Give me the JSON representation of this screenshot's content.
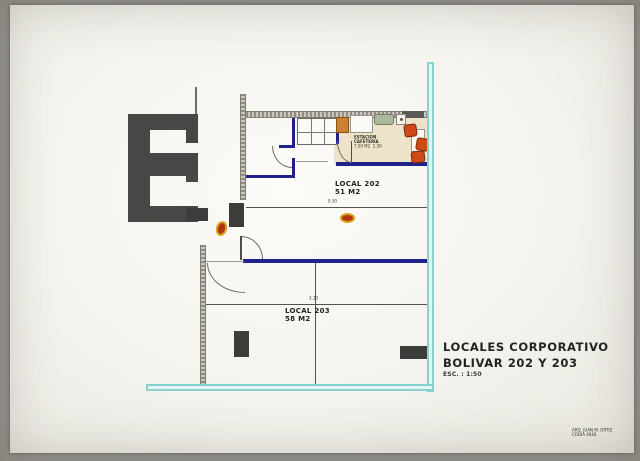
{
  "titleblock": {
    "line1": "LOCALES CORPORATIVO",
    "line2": "BOLIVAR 202 Y 203",
    "scale": "ESC. : 1:50"
  },
  "signature": {
    "line1": "ARQ. JUAN M. ORTIZ",
    "line2": "CODIA 4646"
  },
  "rooms": {
    "local202": {
      "name": "LOCAL 202",
      "area": "51 M2"
    },
    "local203": {
      "name": "LOCAL 203",
      "area": "58 M2"
    },
    "cafeteria": {
      "name_line1": "ESTACION",
      "name_line2": "CAFETERIA",
      "area": "7.50 M2",
      "dim": "1.30"
    }
  },
  "dimensions": {
    "d1": "0.30",
    "d2": "3.10"
  },
  "colors": {
    "wall_blue": "#20218a",
    "glass_cyan": "#86d2cf",
    "furniture_orange": "#cf4a18",
    "floor_beige": "#ece3c8",
    "structure_gray": "#474745"
  }
}
